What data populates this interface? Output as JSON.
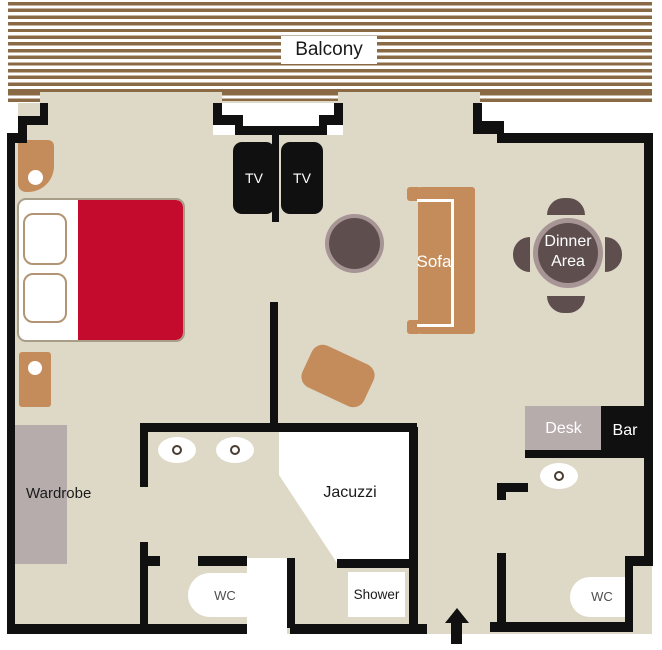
{
  "plan": {
    "title": "Suite floor plan",
    "areas": {
      "balcony": {
        "label": "Balcony"
      },
      "living": {
        "tv_left": "TV",
        "tv_right": "TV",
        "sofa": "Sofa",
        "dinner_line1": "Dinner",
        "dinner_line2": "Area"
      },
      "bedroom": {
        "wardrobe": "Wardrobe"
      },
      "bathroom": {
        "jacuzzi": "Jacuzzi",
        "shower": "Shower",
        "wc": "WC"
      },
      "guest": {
        "desk": "Desk",
        "bar": "Bar",
        "wc": "WC"
      }
    }
  },
  "colors": {
    "floor": "#ded9c7",
    "wall": "#101010",
    "balcony-stripe": "#8a6a45",
    "furniture-brown": "#c48c5b",
    "bed-red": "#c40b2d",
    "bed-border": "#a89d87",
    "pillow-border": "#b29574",
    "cabinet-gray": "#b7acac",
    "table-dark": "#5e4e4e",
    "table-ring": "#a79595",
    "wc-text": "#4f4f4f"
  }
}
